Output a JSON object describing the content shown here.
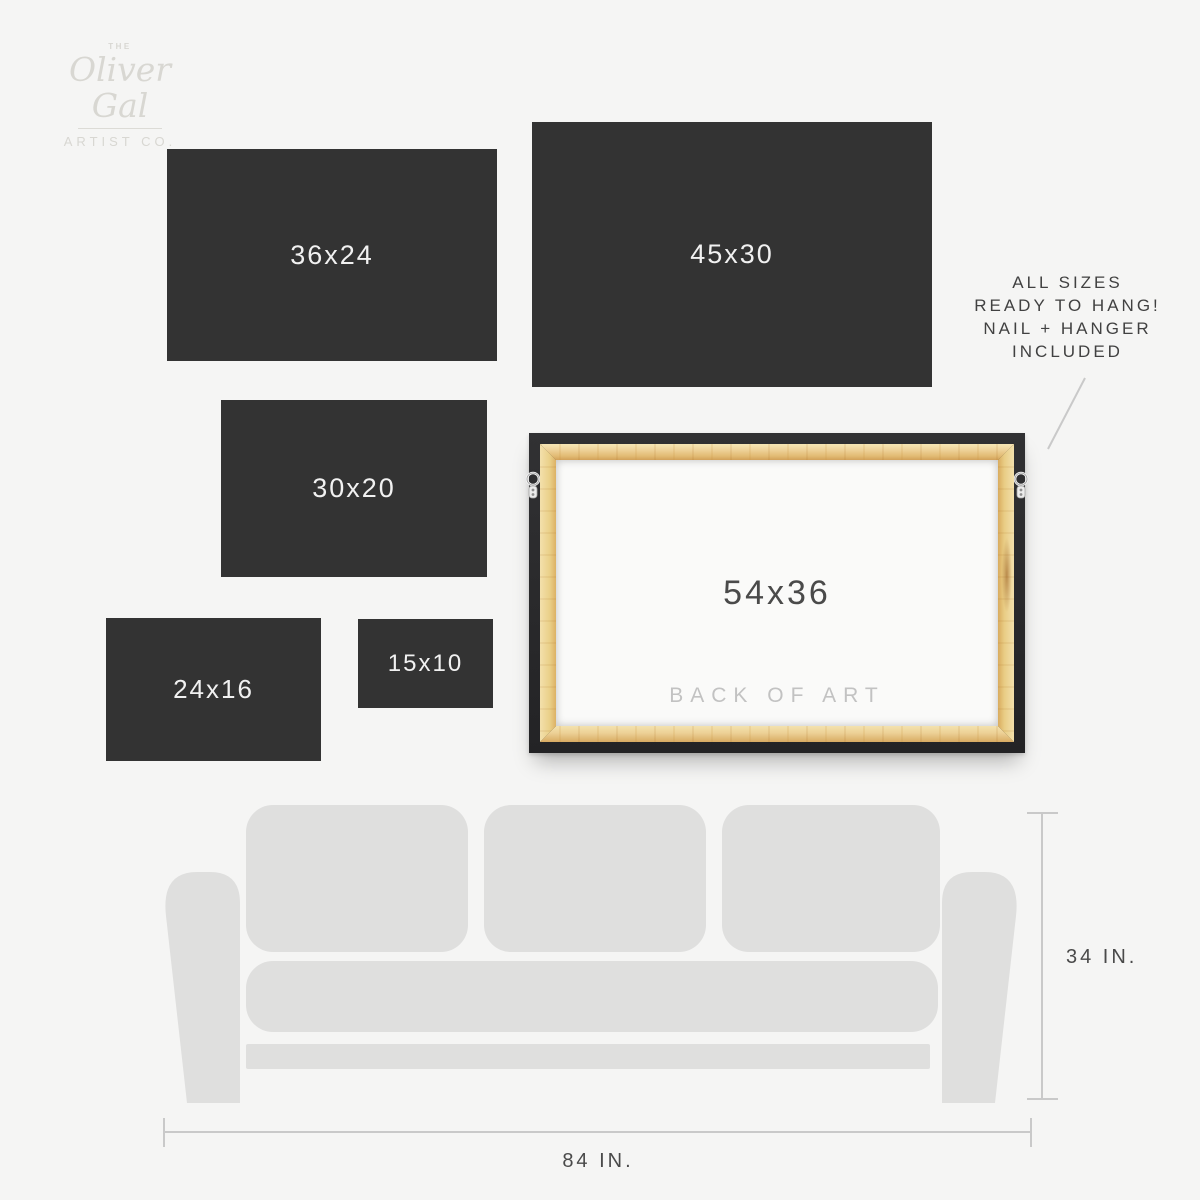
{
  "brand": {
    "prefix": "THE",
    "script": "Oliver Gal",
    "suffix": "ARTIST CO."
  },
  "size_tiles": [
    {
      "label": "36x24"
    },
    {
      "label": "45x30"
    },
    {
      "label": "30x20"
    },
    {
      "label": "24x16"
    },
    {
      "label": "15x10"
    }
  ],
  "back_of_art": {
    "size_label": "54x36",
    "caption": "BACK OF ART"
  },
  "callout": {
    "line1": "ALL SIZES",
    "line2": "READY TO HANG!",
    "line3": "NAIL + HANGER",
    "line4": "INCLUDED"
  },
  "couch": {
    "height_label": "34 IN.",
    "width_label": "84 IN."
  },
  "colors": {
    "background": "#f5f5f4",
    "tile": "#333333",
    "tile_text": "#f1f1f1",
    "couch": "#dfdfde",
    "measure_line": "#c9c9c9",
    "dark_text": "#414141",
    "logo_gray": "#d8d7d2",
    "frame_black": "#2a2a2c",
    "wood_light": "#f3e0ac",
    "wood_dark": "#d9ab5e",
    "canvas_back": "#fafaf9",
    "caption_gray": "#c2c2c2"
  }
}
